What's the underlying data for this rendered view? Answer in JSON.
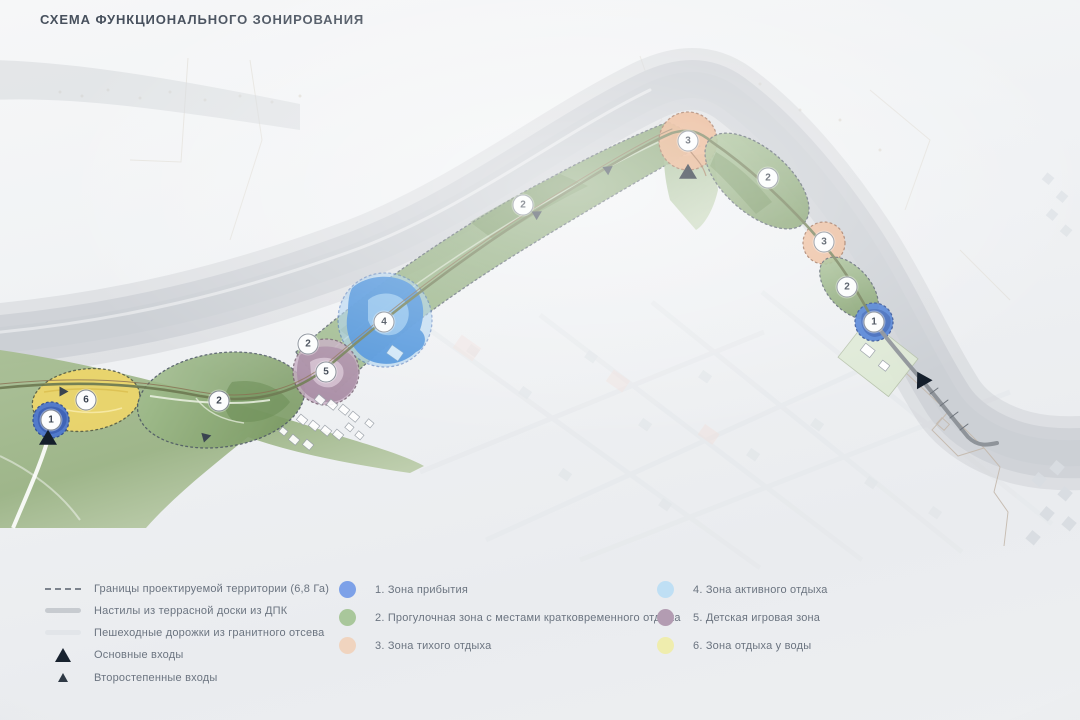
{
  "title": "СХЕМА ФУНКЦИОНАЛЬНОГО ЗОНИРОВАНИЯ",
  "legend": {
    "linear": [
      {
        "label": "Границы проектируемой территории (6,8 Га)",
        "symbol": "dashed-line"
      },
      {
        "label": "Настилы из террасной доски из ДПК",
        "symbol": "decking-line"
      },
      {
        "label": "Пешеходные дорожки из гранитного отсева",
        "symbol": "gravel-line"
      },
      {
        "label": "Основные входы",
        "symbol": "large-triangle"
      },
      {
        "label": "Второстепенные входы",
        "symbol": "small-triangle"
      }
    ],
    "zones": [
      {
        "num": "1",
        "label": "1. Зона прибытия",
        "color": "#7da1e8"
      },
      {
        "num": "2",
        "label": "2. Прогулочная зона с местами кратковременного отдыха",
        "color": "#a9c79b"
      },
      {
        "num": "3",
        "label": "3. Зона тихого отдыха",
        "color": "#f0d4bf"
      },
      {
        "num": "4",
        "label": "4. Зона активного отдыха",
        "color": "#bfdff4"
      },
      {
        "num": "5",
        "label": "5. Детская игровая зона",
        "color": "#b39cb2"
      },
      {
        "num": "6",
        "label": "6. Зона отдыха у воды",
        "color": "#efedae"
      }
    ]
  },
  "map": {
    "zone_markers": [
      {
        "num": "1",
        "x": 51,
        "y": 420
      },
      {
        "num": "6",
        "x": 86,
        "y": 400
      },
      {
        "num": "2",
        "x": 219,
        "y": 401
      },
      {
        "num": "2",
        "x": 308,
        "y": 344
      },
      {
        "num": "5",
        "x": 326,
        "y": 372
      },
      {
        "num": "4",
        "x": 384,
        "y": 322
      },
      {
        "num": "2",
        "x": 523,
        "y": 205
      },
      {
        "num": "3",
        "x": 688,
        "y": 141
      },
      {
        "num": "2",
        "x": 768,
        "y": 178
      },
      {
        "num": "3",
        "x": 824,
        "y": 242
      },
      {
        "num": "2",
        "x": 847,
        "y": 287
      },
      {
        "num": "1",
        "x": 874,
        "y": 322
      }
    ],
    "entrances": {
      "main": [
        {
          "x": 48,
          "y": 438,
          "rot": 0
        },
        {
          "x": 688,
          "y": 172,
          "rot": 0
        },
        {
          "x": 921,
          "y": 379,
          "rot": -30
        }
      ],
      "secondary": [
        {
          "x": 64,
          "y": 392,
          "rot": 90
        },
        {
          "x": 207,
          "y": 437,
          "rot": 75
        },
        {
          "x": 538,
          "y": 214,
          "rot": 60
        },
        {
          "x": 609,
          "y": 169,
          "rot": 55
        }
      ]
    },
    "colors": {
      "river_band": "#d0d3d8",
      "park_green": "#8fae7c",
      "boardwalk": "#6f7b53"
    }
  }
}
